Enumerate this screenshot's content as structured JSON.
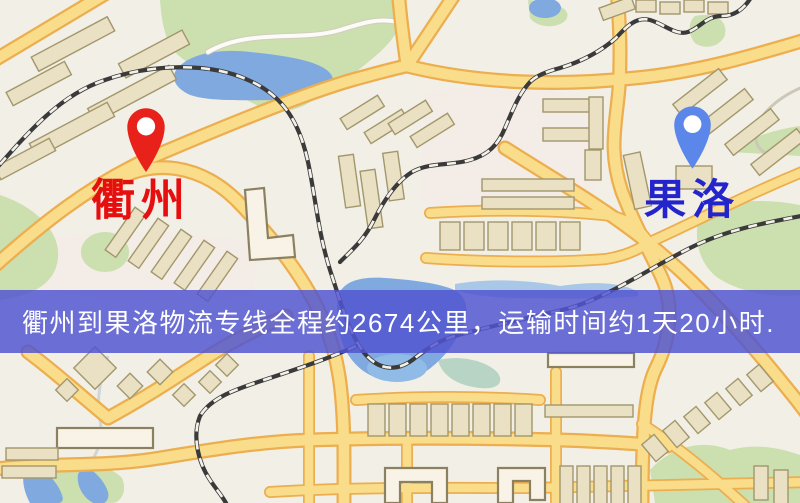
{
  "map": {
    "origin": {
      "name": "衢州",
      "pin_color": "#e8221a",
      "label_color": "#e60f0f"
    },
    "destination": {
      "name": "果洛",
      "pin_color": "#5b87ea",
      "label_color": "#2424cd"
    }
  },
  "banner": {
    "text": "衢州到果洛物流专线全程约2674公里，运输时间约1天20小时.",
    "distance_km": "2674",
    "duration": "1天20小时",
    "background_color": "#5155d1",
    "text_color": "#ffffff"
  },
  "palette": {
    "background": "#f2efe7",
    "park": "#ccdfae",
    "water": "#7fa9df",
    "road": "#f9dd8b",
    "road_casing": "#ecae4e",
    "rail": "#3a3a3a",
    "bldg": "#eae0c3",
    "banner": "#5155d1"
  }
}
